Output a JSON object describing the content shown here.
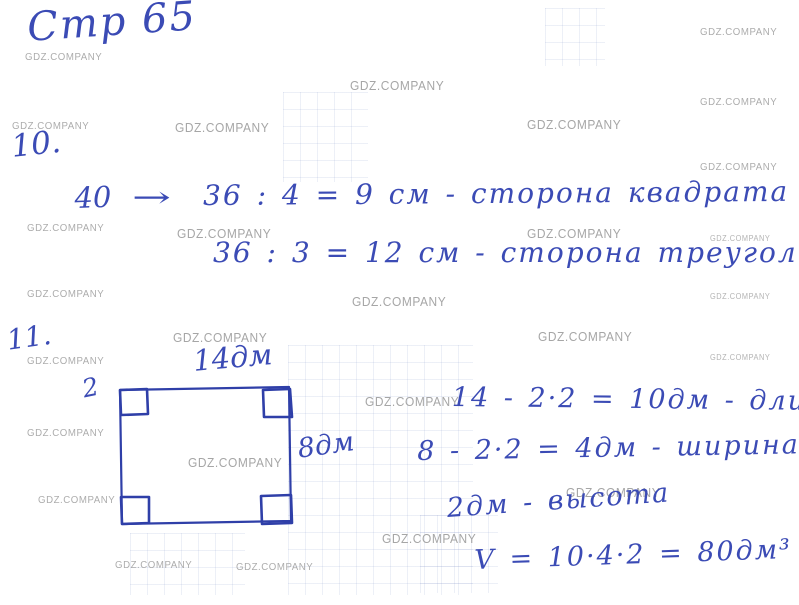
{
  "colors": {
    "ink": "#3b4bb5",
    "watermark": "#a6a6a6",
    "paper": "#ffffff"
  },
  "watermark": {
    "text": "GDZ.COMPANY",
    "instances": [
      {
        "x": 350,
        "y": 78,
        "size": "lg"
      },
      {
        "x": 175,
        "y": 120,
        "size": "lg"
      },
      {
        "x": 527,
        "y": 117,
        "size": "lg"
      },
      {
        "x": 177,
        "y": 226,
        "size": "lg"
      },
      {
        "x": 527,
        "y": 226,
        "size": "lg"
      },
      {
        "x": 352,
        "y": 294,
        "size": "lg"
      },
      {
        "x": 173,
        "y": 330,
        "size": "lg"
      },
      {
        "x": 538,
        "y": 329,
        "size": "lg"
      },
      {
        "x": 365,
        "y": 394,
        "size": "lg"
      },
      {
        "x": 188,
        "y": 455,
        "size": "lg"
      },
      {
        "x": 566,
        "y": 485,
        "size": "lg"
      },
      {
        "x": 382,
        "y": 531,
        "size": "lg"
      },
      {
        "x": 25,
        "y": 51,
        "size": "sm"
      },
      {
        "x": 12,
        "y": 120,
        "size": "sm"
      },
      {
        "x": 27,
        "y": 222,
        "size": "sm"
      },
      {
        "x": 27,
        "y": 288,
        "size": "sm"
      },
      {
        "x": 27,
        "y": 355,
        "size": "sm"
      },
      {
        "x": 27,
        "y": 427,
        "size": "sm"
      },
      {
        "x": 38,
        "y": 494,
        "size": "sm"
      },
      {
        "x": 115,
        "y": 559,
        "size": "sm"
      },
      {
        "x": 236,
        "y": 561,
        "size": "sm"
      },
      {
        "x": 700,
        "y": 26,
        "size": "sm"
      },
      {
        "x": 700,
        "y": 96,
        "size": "sm"
      },
      {
        "x": 700,
        "y": 161,
        "size": "sm"
      },
      {
        "x": 710,
        "y": 234,
        "size": "xs"
      },
      {
        "x": 710,
        "y": 292,
        "size": "xs"
      },
      {
        "x": 710,
        "y": 353,
        "size": "xs"
      }
    ]
  },
  "heading": {
    "page_label": "Стр 65"
  },
  "problem10": {
    "number": "10.",
    "given": "40",
    "arrow": "→",
    "line1": "36 : 4 = 9 см - сторона квадрата",
    "line2": "36 : 3 = 12 см - сторона треугольника"
  },
  "problem11": {
    "number": "11.",
    "figure": {
      "top_label": "14дм",
      "left_label": "2",
      "right_label": "8дм"
    },
    "calc_length": "14 - 2·2 = 10дм - длина",
    "calc_width": "8 - 2·2 = 4дм - ширина",
    "calc_height": "2дм - высота",
    "calc_volume": "V = 10·4·2 = 80дм³"
  }
}
